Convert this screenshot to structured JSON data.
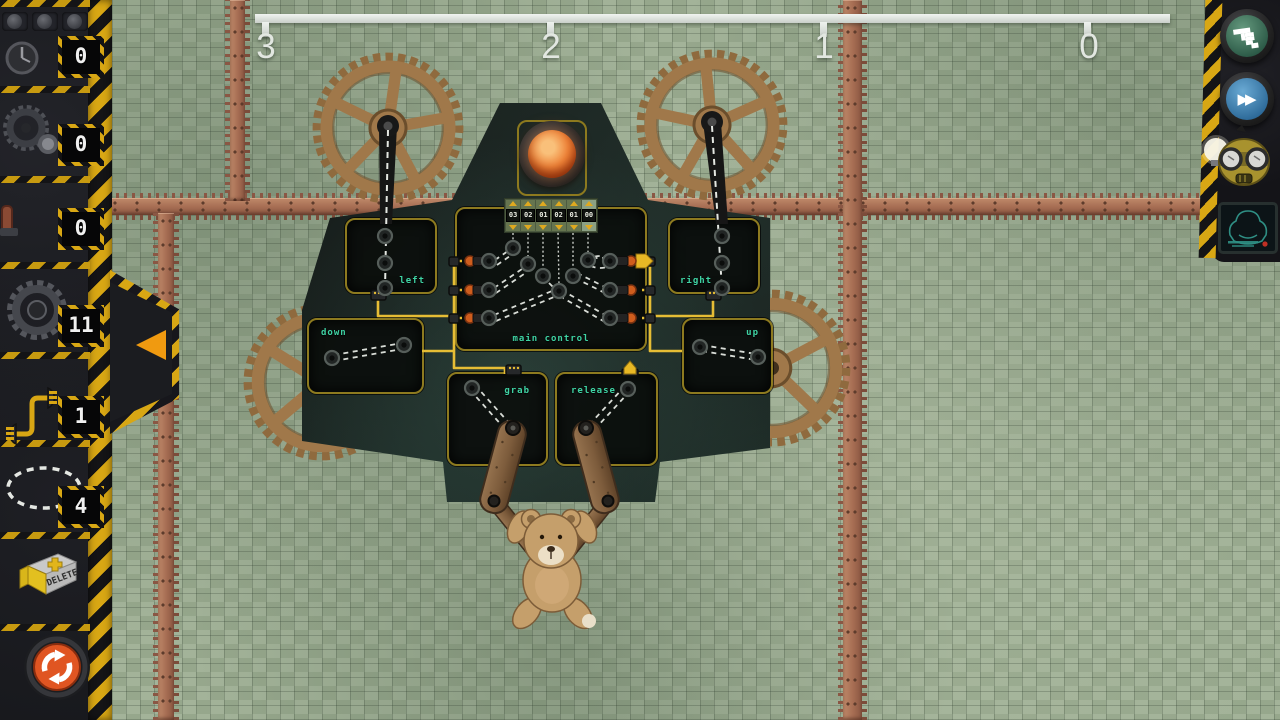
{
  "hud": {
    "ruler": {
      "marks": [
        "3",
        "2",
        "1",
        "0"
      ]
    },
    "toolbar": {
      "slots": [
        {
          "icon": "timer-gauge-icon",
          "count": "0"
        },
        {
          "icon": "small-gear-icon",
          "count": "0"
        },
        {
          "icon": "lever-icon",
          "count": "0"
        },
        {
          "icon": "large-gear-icon",
          "count": "11"
        },
        {
          "icon": "wire-connector-icon",
          "count": "1"
        },
        {
          "icon": "selection-loop-icon",
          "count": "4"
        }
      ],
      "delete_label": "DELETE"
    },
    "controls": {
      "run_icon": "hand-cursor-icon",
      "fast_forward_icon": "fast-forward-icon",
      "character_icon": "robot-goggles-icon",
      "goal_screen_icon": "goal-silhouette-screen"
    }
  },
  "machine": {
    "modules": {
      "left": "left",
      "right": "right",
      "down": "down",
      "up": "up",
      "grab": "grab",
      "release": "release",
      "main": "main control"
    },
    "counters": [
      "03",
      "02",
      "01",
      "02",
      "01",
      "00"
    ]
  },
  "colors": {
    "accent_yellow": "#d8a714",
    "module_label": "#3fd3a4",
    "wire": "#e6bd35",
    "lamp": "#ee7a30",
    "tile_base": "#96a78c",
    "copper": "#a9705a"
  }
}
